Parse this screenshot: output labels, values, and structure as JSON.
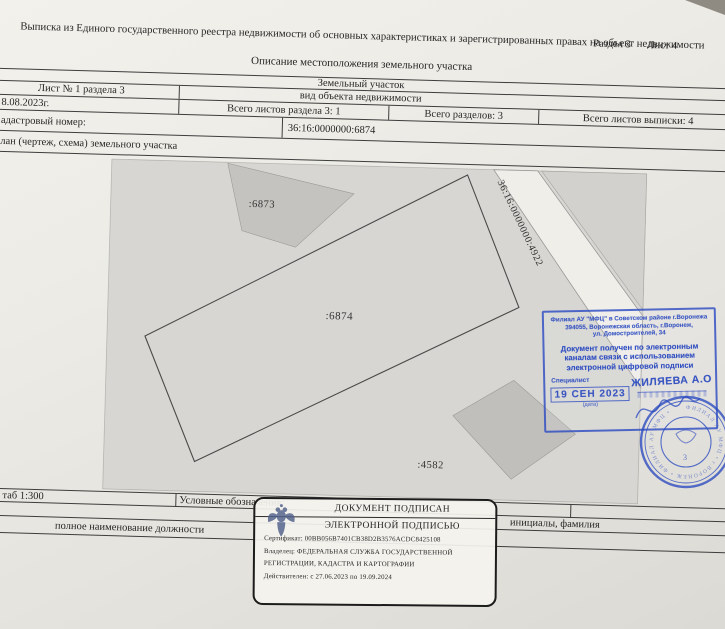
{
  "document": {
    "section": "Раздел 3",
    "sheet": "Лист 4",
    "title": "Выписка из Единого государственного реестра недвижимости об основных характеристиках и зарегистрированных правах на объект недвижимости",
    "subtitle": "Описание местоположения земельного участка"
  },
  "header_table": {
    "object_type": "Земельный участок",
    "object_type_caption": "вид объекта недвижимости",
    "sheet_info": "Лист № 1 раздела 3",
    "date": "8.08.2023г.",
    "total_sheets_of_section": "Всего листов раздела 3: 1",
    "total_sections": "Всего разделов: 3",
    "total_sheets_of_extract": "Всего листов выписки: 4",
    "cadastral_label": "адастровый номер:",
    "cadastral_number": "36:16:0000000:6874",
    "plan_row_label": "лан (чертеж, схема) земельного участка"
  },
  "plan": {
    "parcel_top": ":6873",
    "parcel_main": ":6874",
    "parcel_bottom": ":4582",
    "adjacent_parcel": "36:16:0000000:4922"
  },
  "footer": {
    "scale": "таб 1:300",
    "legend": "Условные обозначения:",
    "position_caption": "полное наименование должности",
    "name_caption": "инициалы, фамилия"
  },
  "mfc_stamp": {
    "addr1": "Филиал АУ \"МФЦ\" в  Советском районе г.Воронежа",
    "addr2": "394055, Воронежская область, г.Воронеж,",
    "addr3": "ул. Домостроителей, 34",
    "body1": "Документ получен по электронным",
    "body2": "каналам связи с использованием",
    "body3": "электронной цифровой подписи",
    "specialist": "Специалист",
    "name": "ЖИЛЯЕВА А.О",
    "date": "19 СЕН 2023",
    "date_caption": "(дата)"
  },
  "signature": {
    "line1": "ДОКУМЕНТ ПОДПИСАН",
    "line2": "ЭЛЕКТРОННОЙ ПОДПИСЬЮ",
    "certificate": "Сертификат: 00BB056B7401CB38D2B3576ACDC8425108",
    "owner1": "Владелец: ФЕДЕРАЛЬНАЯ СЛУЖБА ГОСУДАРСТВЕННОЙ",
    "owner2": "РЕГИСТРАЦИИ, КАДАСТРА И КАРТОГРАФИИ",
    "valid": "Действителен: с 27.06.2023 по 19.09.2024"
  },
  "seal_text": "ФИЛИАЛ АУ МФЦ • г.ВОРОНЕЖ • ФИЛИАЛ АУ МФЦ •"
}
